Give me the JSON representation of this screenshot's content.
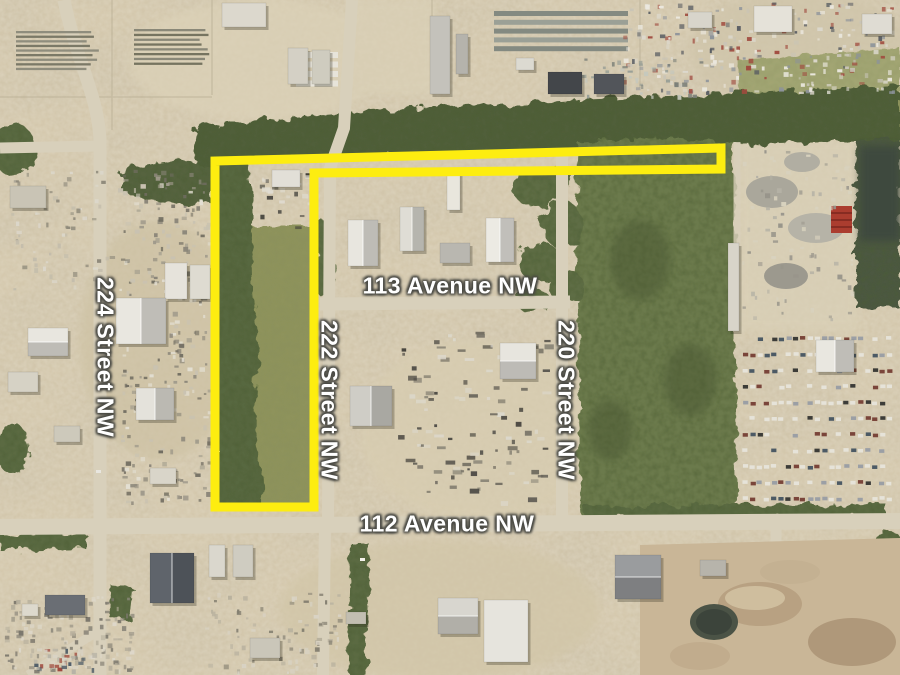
{
  "map": {
    "labels": [
      {
        "id": "street-224",
        "text": "224 Street NW",
        "orientation": "vertical"
      },
      {
        "id": "street-222",
        "text": "222 Street NW",
        "orientation": "vertical"
      },
      {
        "id": "street-220",
        "text": "220 Street NW",
        "orientation": "vertical"
      },
      {
        "id": "avenue-113",
        "text": "113 Avenue NW",
        "orientation": "horizontal"
      },
      {
        "id": "avenue-112",
        "text": "112 Avenue NW",
        "orientation": "horizontal"
      }
    ],
    "boundary": {
      "color": "#ffee00",
      "stroke_width": 9,
      "points": [
        [
          215,
          507
        ],
        [
          215,
          161
        ],
        [
          721,
          148
        ],
        [
          721,
          169
        ],
        [
          314,
          173
        ],
        [
          314,
          507
        ]
      ]
    },
    "palette": {
      "ground": "#d5c8ab",
      "road": "#d9d0b9",
      "trees_dark": "#4f5e38",
      "forest": "#6a7a4a",
      "grass": "#8e9359",
      "water_pond": "#3e4a3e",
      "label_text": "#ffffff",
      "label_halo": "#4a4a44"
    }
  }
}
